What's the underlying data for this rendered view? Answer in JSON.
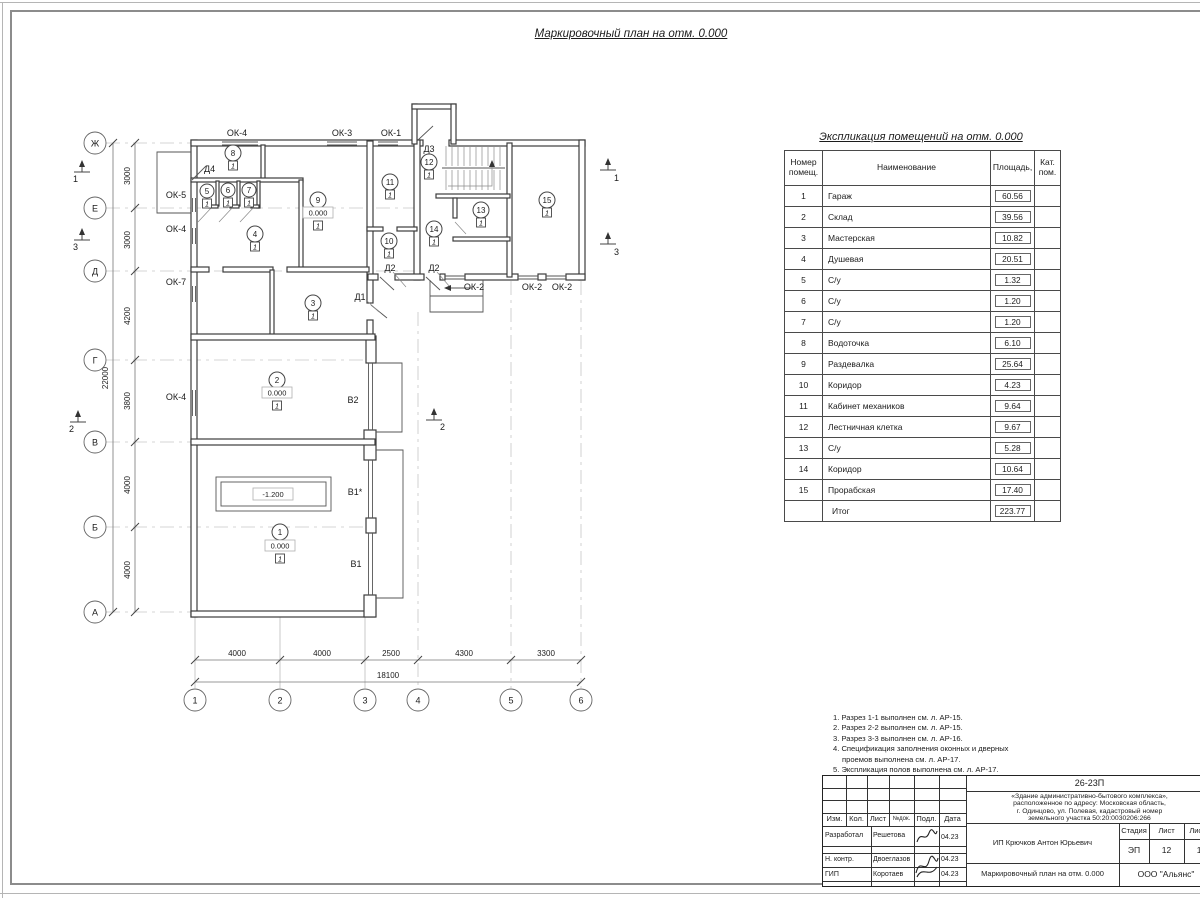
{
  "sheet": {
    "main_title": "Маркировочный план на отм. 0.000"
  },
  "plan": {
    "axis_rows": [
      "Ж",
      "Е",
      "Д",
      "Г",
      "В",
      "Б",
      "А"
    ],
    "axis_cols": [
      "1",
      "2",
      "3",
      "4",
      "5",
      "6"
    ],
    "dims_left": [
      "3000",
      "3000",
      "4200",
      "3800",
      "4000",
      "4000"
    ],
    "dims_left_total": "22000",
    "dims_bottom": [
      "4000",
      "4000",
      "2500",
      "4300",
      "3300"
    ],
    "dims_bottom_total": "18100",
    "win": {
      "ok1": "ОК-1",
      "ok2": "ОК-2",
      "ok3": "ОК-3",
      "ok4": "ОК-4",
      "ok5": "ОК-5",
      "ok7": "ОК-7"
    },
    "doors": {
      "d1": "Д1",
      "d2": "Д2",
      "d3": "Д3",
      "d4": "Д4"
    },
    "gates": {
      "v1": "В1",
      "v1s": "В1*",
      "v2": "В2"
    },
    "levels": {
      "zero": "0.000",
      "pit": "-1.200"
    },
    "floor_mark": "1",
    "marks": {
      "m1": "1",
      "m2": "2",
      "m3": "3",
      "m4": "4",
      "m5": "5",
      "m6": "6",
      "m7": "7",
      "m8": "8",
      "m9": "9",
      "m10": "10",
      "m11": "11",
      "m12": "12",
      "m13": "13",
      "m14": "14",
      "m15": "15"
    },
    "sections": {
      "s1": "1",
      "s2": "2",
      "s3": "3"
    }
  },
  "table": {
    "title": "Экспликация помещений на отм. 0.000",
    "headers": {
      "num1": "Номер",
      "num2": "помещ.",
      "name": "Наименование",
      "area": "Площадь,",
      "cat1": "Кат.",
      "cat2": "пом."
    },
    "rows": [
      {
        "n": "1",
        "name": "Гараж",
        "area": "60.56"
      },
      {
        "n": "2",
        "name": "Склад",
        "area": "39.56"
      },
      {
        "n": "3",
        "name": "Мастерская",
        "area": "10.82"
      },
      {
        "n": "4",
        "name": "Душевая",
        "area": "20.51"
      },
      {
        "n": "5",
        "name": "С/у",
        "area": "1.32"
      },
      {
        "n": "6",
        "name": "С/у",
        "area": "1.20"
      },
      {
        "n": "7",
        "name": "С/у",
        "area": "1.20"
      },
      {
        "n": "8",
        "name": "Водоточка",
        "area": "6.10"
      },
      {
        "n": "9",
        "name": "Раздевалка",
        "area": "25.64"
      },
      {
        "n": "10",
        "name": "Коридор",
        "area": "4.23"
      },
      {
        "n": "11",
        "name": "Кабинет механиков",
        "area": "9.64"
      },
      {
        "n": "12",
        "name": "Лестничная клетка",
        "area": "9.67"
      },
      {
        "n": "13",
        "name": "С/у",
        "area": "5.28"
      },
      {
        "n": "14",
        "name": "Коридор",
        "area": "10.64"
      },
      {
        "n": "15",
        "name": "Прорабская",
        "area": "17.40"
      }
    ],
    "total": {
      "label": "Итог",
      "area": "223.77"
    }
  },
  "notes": {
    "lines": [
      "1. Разрез 1-1 выполнен см. л. АР-15.",
      "2. Разрез 2-2 выполнен см. л. АР-15.",
      "3. Разрез 3-3 выполнен см. л. АР-16.",
      "4. Спецификация заполнения оконных и дверных",
      "проемов выполнена см. л. АР-17.",
      "5. Экспликация полов выполнена см. л. АР-17."
    ]
  },
  "stamp": {
    "code": "26-23П",
    "project_lines": [
      "«Здание административно-бытового комплекса»,",
      "расположенное по адресу: Московская область,",
      "г. Одинцово, ул. Полевая, кадастровый номер",
      "земельного участка 50:20:0030206:266"
    ],
    "cols": {
      "izm": "Изм.",
      "kol": "Кол.",
      "list": "Лист",
      "ndok": "№док.",
      "podp": "Подл.",
      "data": "Дата"
    },
    "rows": [
      {
        "role": "Разработал",
        "name": "Решетова",
        "date": "04.23"
      },
      {
        "role": "Н. контр.",
        "name": "Двоеглазов",
        "date": "04.23"
      },
      {
        "role": "ГИП",
        "name": "Коротаев",
        "date": "04.23"
      }
    ],
    "customer": "ИП Крючков Антон Юрьевич",
    "stage_label": "Стадия",
    "sheet_label": "Лист",
    "sheets_label": "Листов",
    "stage": "ЭП",
    "sheet": "12",
    "sheets": "17",
    "doc_title": "Маркировочный план на отм. 0.000",
    "company": "ООО \"Альянс\""
  }
}
